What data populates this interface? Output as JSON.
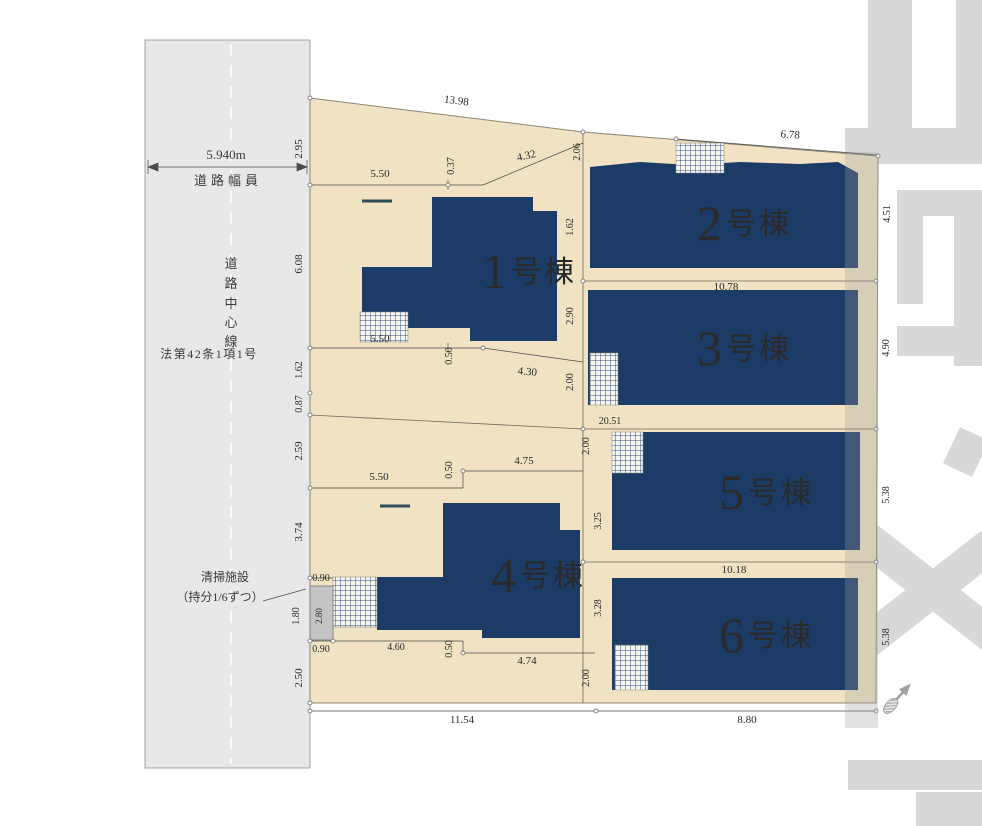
{
  "colors": {
    "parcel": "#f0e2c2",
    "parcel_border": "#8c8678",
    "building": "#1c3b66",
    "building_label": "#c6ab72",
    "road": "#e8e8ea",
    "road_line": "#a0a0a0",
    "watermark": "#d8d8d8",
    "dim_text": "#2a2a2a",
    "dim_line": "#4a4a4a",
    "facility_box": "#c4c4c4",
    "entry_dash": "#2e4d57",
    "hatch_line": "#35507c"
  },
  "road": {
    "width": "5.940m",
    "width_caption": "道路幅員",
    "centerline_chars": [
      "道",
      "路",
      "中",
      "心",
      "線"
    ],
    "law": "法第42条1項1号"
  },
  "facility": {
    "line1": "清掃施設",
    "line2": "（持分1/6ずつ）"
  },
  "buildings": [
    {
      "number": "1",
      "suffix": "号棟"
    },
    {
      "number": "2",
      "suffix": "号棟"
    },
    {
      "number": "3",
      "suffix": "号棟"
    },
    {
      "number": "4",
      "suffix": "号棟"
    },
    {
      "number": "5",
      "suffix": "号棟"
    },
    {
      "number": "6",
      "suffix": "号棟"
    }
  ],
  "dims": {
    "top_total": "13.98",
    "top_left_height": "2.95",
    "b1_top_w": "5.50",
    "b1_top_gap": "0.37",
    "b1_top_e": "4.32",
    "mid_top": "2.06",
    "b2_top": "6.78",
    "b2_right": "4.51",
    "left_b1": "6.08",
    "mid_b1_b2": "1.62",
    "row23": "10.78",
    "left_a": "1.62",
    "left_b": "0.87",
    "left_c": "2.59",
    "left_d": "3.74",
    "left_e": "2.50",
    "mid_a": "2.90",
    "mid_b": "2.00",
    "mid_c": "2.00",
    "mid_d": "2.00",
    "b1_bot_w": "5.50",
    "b1_bot_gap": "0.50",
    "b1_bot_e": "4.30",
    "b3_right": "4.90",
    "row35": "20.51",
    "b4_top_w": "5.50",
    "b4_top_gap": "0.50",
    "b4_top_e": "4.75",
    "b5_left": "3.25",
    "b5_right": "5.38",
    "fac_top": "0.90",
    "fac_side": "1.80",
    "fac_inner": "2.80",
    "fac_bot": "0.90",
    "b4_bot_w": "4.60",
    "b4_bot_gap": "0.50",
    "b4_bot_e": "4.74",
    "row56": "10.18",
    "b6_left": "3.28",
    "b6_right": "5.38",
    "bottom_left": "11.54",
    "bottom_right": "8.80"
  }
}
